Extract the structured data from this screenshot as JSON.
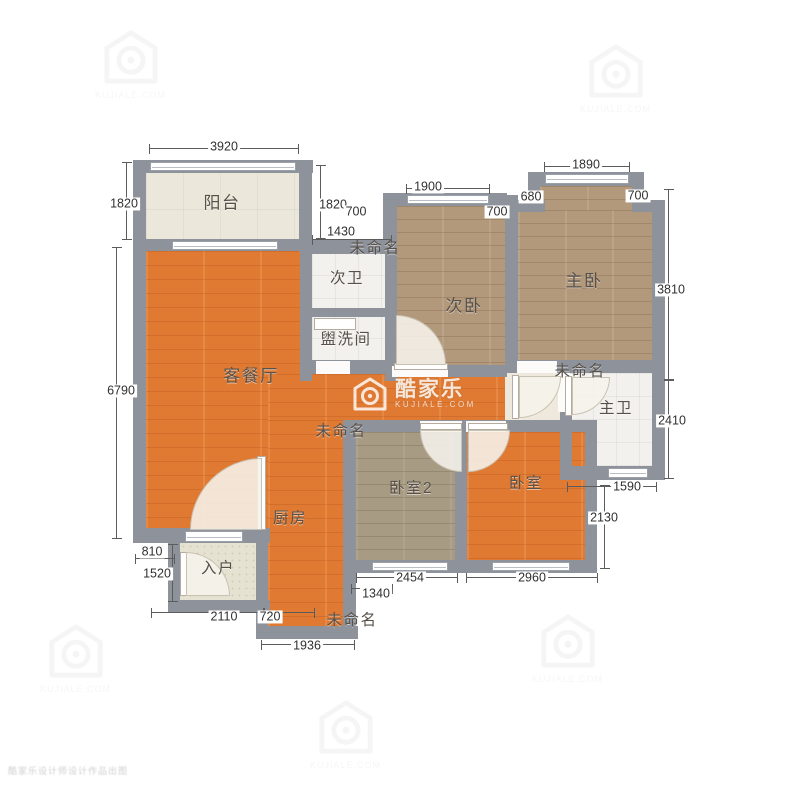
{
  "rooms": {
    "balcony": "阳台",
    "living_dining": "客餐厅",
    "second_bath": "次卫",
    "washroom": "盥洗间",
    "second_bedroom": "次卧",
    "master_bedroom": "主卧",
    "master_bath": "主卫",
    "kitchen": "厨房",
    "bedroom2": "卧室2",
    "bedroom": "卧室",
    "entry": "入户",
    "unnamed": "未命名"
  },
  "dims": {
    "d3920": "3920",
    "d1820l": "1820",
    "d1820r": "1820",
    "d1430": "1430",
    "d700a": "700",
    "d1900": "1900",
    "d700b": "700",
    "d680": "680",
    "d1890": "1890",
    "d700c": "700",
    "d3810": "3810",
    "d6790": "6790",
    "d2410": "2410",
    "d1590": "1590",
    "d2130": "2130",
    "d810": "810",
    "d1520": "1520",
    "d2110": "2110",
    "d720": "720",
    "d1936": "1936",
    "d1340": "1340",
    "d2454": "2454",
    "d2960": "2960"
  },
  "watermark": {
    "brand": "酷家乐",
    "domain": "KUJIALE.COM",
    "corner_text": "酷家乐设计师设计作品出图"
  },
  "colors": {
    "wall": "#8d929b",
    "wood_orange": "#e07a33",
    "wood_brown": "#b3997c",
    "wood_gray": "#a89b84",
    "tile_white": "#f2f1ee",
    "balcony_cream": "#ebe8db"
  }
}
